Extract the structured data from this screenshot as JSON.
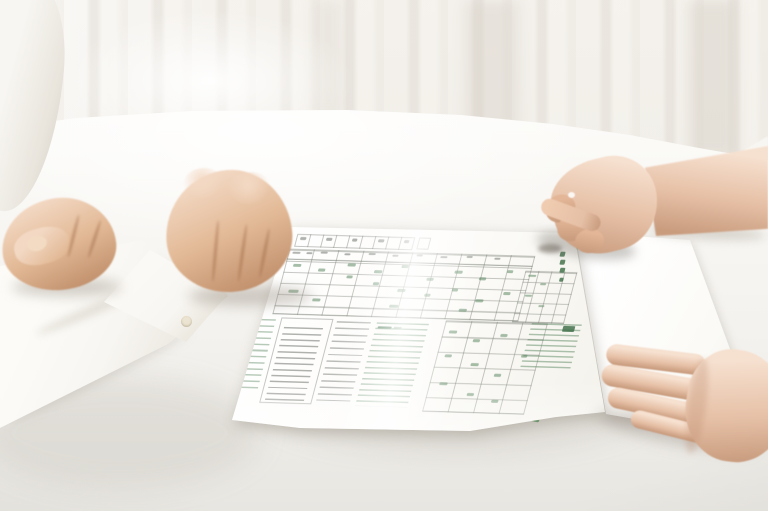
{
  "meta": {
    "width": 768,
    "height": 511,
    "kind": "photograph",
    "scene": "two-people-reviewing-form-at-white-table"
  },
  "colors": {
    "curtain_base": "#f4f1ec",
    "curtain_mid": "#efece6",
    "table_light": "#fbfaf7",
    "table_mid": "#f3f1ed",
    "table_dark": "#e8e6e1",
    "shirt": "#f8f6f2",
    "shirt_shade": "#e9e5dd",
    "shirt_deep": "#d9d4c9",
    "skin_hi": "#f3d9c4",
    "skin_mid": "#e2b996",
    "skin_low": "#c08e6a",
    "skin_crease": "rgba(150,95,60,0.45)",
    "skin2_hi": "#f6e0cf",
    "skin2_mid": "#e6c0a6",
    "skin2_low": "#c99c7e",
    "paper": "#fcfbf8",
    "sheet": "#fbfaf6",
    "stripe_a": "#6aa571",
    "stripe_b": "#54915d",
    "stripe_c": "#5f9c67",
    "line": "rgba(115,120,110,0.42)",
    "line_strong": "rgba(100,106,96,0.6)",
    "txt_gray": "rgba(110,115,108,0.55)",
    "txt_green": "rgba(92,136,98,0.55)",
    "txt_dark": "rgba(58,108,68,0.8)",
    "nail": "#f2dbc2",
    "button": "#ece4d2"
  },
  "form": {
    "header_cells": 9,
    "main_table": {
      "columns": 10,
      "rows": 6
    },
    "side_table": {
      "columns": 4,
      "rows": 5
    },
    "bottom_table": {
      "columns": 4,
      "rows": 6
    },
    "specks": [
      [
        34,
        9,
        6,
        3,
        "k"
      ],
      [
        60,
        9,
        6,
        3,
        "k"
      ],
      [
        86,
        9,
        5,
        3,
        "k"
      ],
      [
        112,
        9,
        6,
        3,
        "k"
      ],
      [
        138,
        9,
        5,
        3,
        "k"
      ],
      [
        30,
        24,
        8,
        2,
        "k"
      ],
      [
        44,
        24,
        6,
        2,
        "k"
      ],
      [
        58,
        23,
        7,
        2,
        "k"
      ],
      [
        82,
        24,
        6,
        2,
        "k"
      ],
      [
        106,
        23,
        7,
        2,
        "k"
      ],
      [
        130,
        24,
        6,
        2,
        "k"
      ],
      [
        154,
        23,
        6,
        2,
        "k"
      ],
      [
        178,
        24,
        7,
        2,
        "k"
      ],
      [
        204,
        23,
        6,
        2,
        "k"
      ],
      [
        232,
        24,
        6,
        2,
        "k"
      ],
      [
        34,
        36,
        8,
        3,
        "g"
      ],
      [
        60,
        40,
        7,
        3,
        "g"
      ],
      [
        88,
        34,
        8,
        3,
        "g"
      ],
      [
        90,
        46,
        6,
        3,
        "g"
      ],
      [
        116,
        40,
        8,
        3,
        "g"
      ],
      [
        118,
        52,
        6,
        3,
        "g"
      ],
      [
        142,
        34,
        7,
        3,
        "g"
      ],
      [
        144,
        58,
        8,
        3,
        "g"
      ],
      [
        170,
        46,
        7,
        3,
        "g"
      ],
      [
        172,
        62,
        6,
        3,
        "g"
      ],
      [
        196,
        38,
        8,
        3,
        "g"
      ],
      [
        198,
        56,
        6,
        3,
        "g"
      ],
      [
        222,
        44,
        7,
        3,
        "g"
      ],
      [
        224,
        66,
        8,
        3,
        "g"
      ],
      [
        248,
        36,
        6,
        3,
        "g"
      ],
      [
        250,
        58,
        7,
        3,
        "g"
      ],
      [
        36,
        62,
        10,
        3,
        "g"
      ],
      [
        62,
        70,
        8,
        3,
        "g"
      ],
      [
        140,
        74,
        9,
        3,
        "g"
      ],
      [
        210,
        76,
        8,
        3,
        "g"
      ],
      [
        270,
        40,
        8,
        2,
        "g"
      ],
      [
        284,
        48,
        6,
        2,
        "g"
      ],
      [
        272,
        60,
        7,
        2,
        "g"
      ],
      [
        288,
        70,
        6,
        2,
        "g"
      ],
      [
        296,
        16,
        5,
        5,
        "d"
      ],
      [
        298,
        24,
        5,
        5,
        "d"
      ],
      [
        300,
        32,
        5,
        5,
        "d"
      ],
      [
        302,
        42,
        4,
        4,
        "d"
      ],
      [
        206,
        98,
        8,
        3,
        "g"
      ],
      [
        232,
        106,
        7,
        3,
        "g"
      ],
      [
        258,
        100,
        7,
        3,
        "g"
      ],
      [
        208,
        122,
        7,
        3,
        "g"
      ],
      [
        236,
        130,
        8,
        3,
        "g"
      ],
      [
        262,
        140,
        7,
        3,
        "g"
      ],
      [
        284,
        120,
        6,
        3,
        "g"
      ],
      [
        210,
        150,
        8,
        3,
        "g"
      ],
      [
        240,
        160,
        7,
        3,
        "g"
      ],
      [
        266,
        166,
        7,
        3,
        "g"
      ],
      [
        134,
        96,
        14,
        2,
        "d"
      ],
      [
        150,
        96,
        8,
        2,
        "g"
      ],
      [
        318,
        90,
        12,
        6,
        "d"
      ]
    ]
  }
}
